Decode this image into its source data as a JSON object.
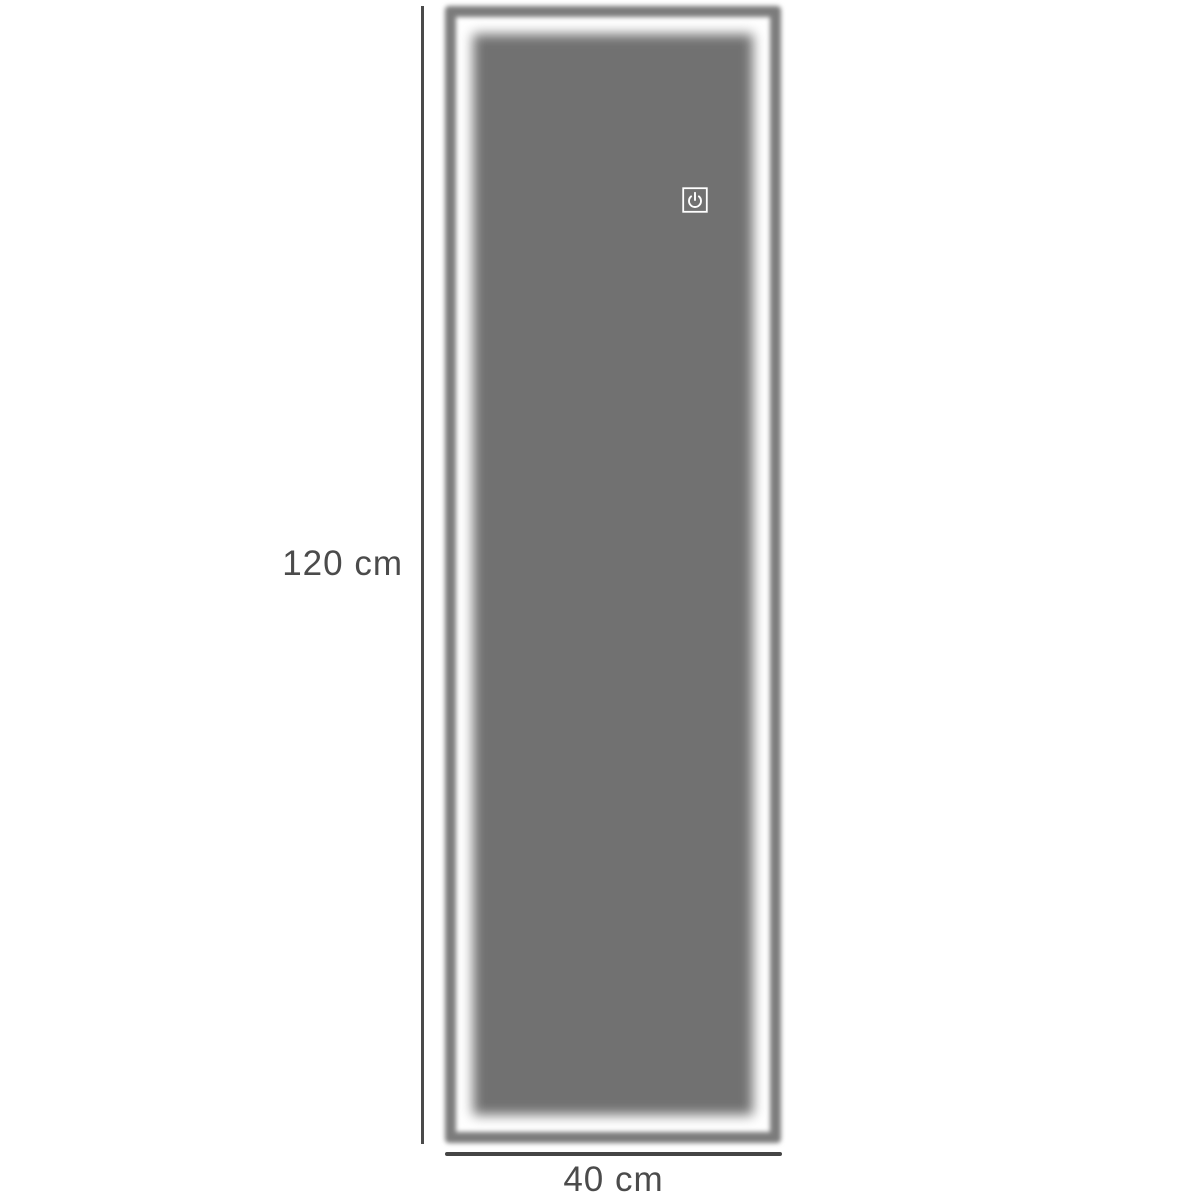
{
  "diagram": {
    "product": "led-mirror-dimension-diagram",
    "dimensions": {
      "height_label": "120 cm",
      "width_label": "40 cm"
    },
    "icons": {
      "power_button": "power-touch-icon"
    },
    "colors": {
      "background": "#ffffff",
      "frame": "#7c7c7c",
      "mirror_surface": "#717171",
      "led_glow": "#ffffff",
      "dimension_lines": "#4a4a4a",
      "label_text": "#4b4b4b",
      "power_icon": "#ffffff"
    }
  }
}
